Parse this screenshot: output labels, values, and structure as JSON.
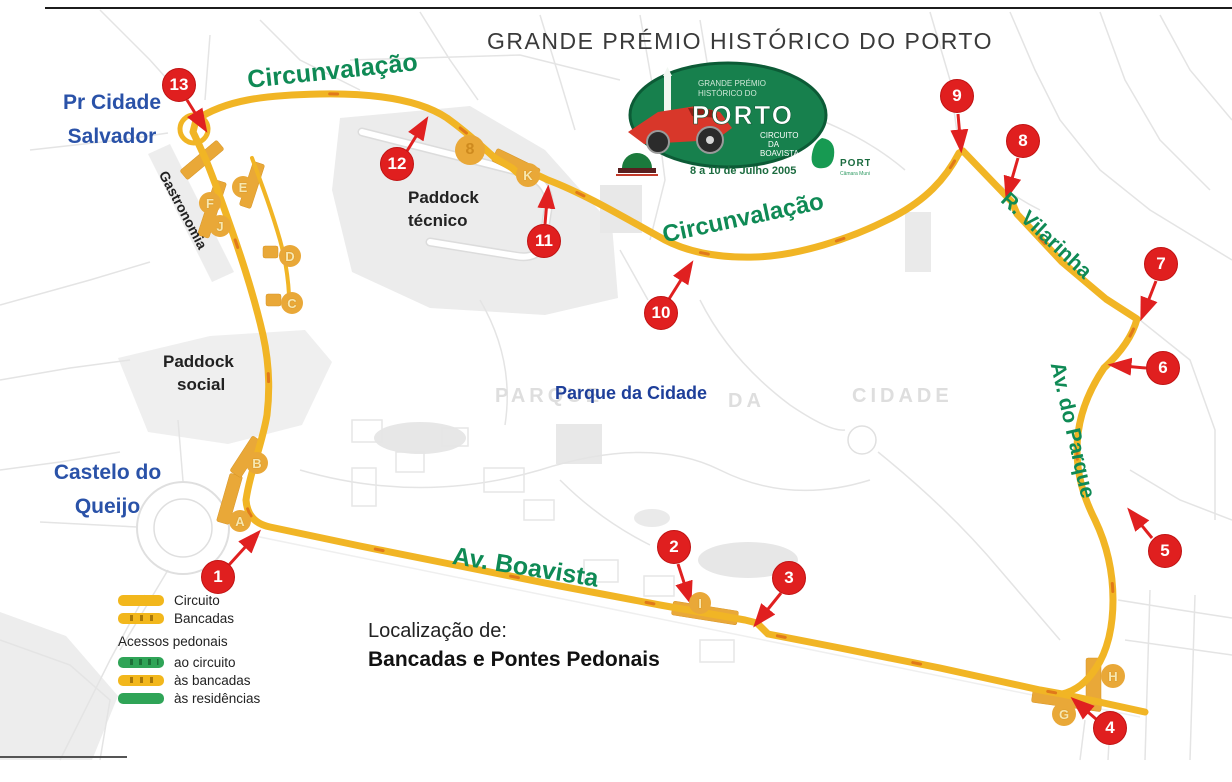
{
  "page": {
    "title": "GRANDE PRÉMIO HISTÓRICO DO PORTO"
  },
  "logo": {
    "line1": "GRANDE PRÉMIO",
    "line2": "HISTÓRICO DO",
    "name": "PORTO",
    "circuit_line1": "CIRCUITO",
    "circuit_line2": "DA",
    "circuit_line3": "BOAVISTA",
    "date": "8 a 10 de Julho 2005",
    "city": "PORTO",
    "city_sub": "Câmara Municipal"
  },
  "labels": {
    "pr_cidade_line1": "Pr Cidade",
    "pr_cidade_line2": "Salvador",
    "castelo_line1": "Castelo do",
    "castelo_line2": "Queijo",
    "paddock_social_line1": "Paddock",
    "paddock_social_line2": "social",
    "paddock_tecnico_line1": "Paddock",
    "paddock_tecnico_line2": "técnico",
    "gastronomia": "Gastronomia",
    "parque_da_cidade": "Parque da Cidade",
    "bg_parque": "PARQUE",
    "bg_da": "DA",
    "bg_cidade": "CIDADE",
    "circunvalacao_top": "Circunvalação",
    "circunvalacao_mid": "Circunvalação",
    "r_vilarinha": "R. Vilarinha",
    "av_do_parque": "Av. do Parque",
    "av_boavista": "Av. Boavista",
    "localizacao": "Localização de:",
    "localizacao_bold": "Bancadas e Pontes Pedonais"
  },
  "legend": {
    "circuito": "Circuito",
    "bancadas": "Bancadas",
    "acessos": "Acessos pedonais",
    "ao_circuito": "ao circuito",
    "as_bancadas": "às bancadas",
    "as_residencias": "às residências"
  },
  "bridges": [
    {
      "label": "1"
    },
    {
      "label": "2"
    },
    {
      "label": "3"
    },
    {
      "label": "4"
    },
    {
      "label": "5"
    },
    {
      "label": "6"
    },
    {
      "label": "7"
    },
    {
      "label": "8"
    },
    {
      "label": "9"
    },
    {
      "label": "10"
    },
    {
      "label": "11"
    },
    {
      "label": "12"
    },
    {
      "label": "13"
    }
  ],
  "stands": [
    {
      "label": "A"
    },
    {
      "label": "B"
    },
    {
      "label": "C"
    },
    {
      "label": "D"
    },
    {
      "label": "E"
    },
    {
      "label": "F"
    },
    {
      "label": "G"
    },
    {
      "label": "H"
    },
    {
      "label": "I"
    },
    {
      "label": "J"
    },
    {
      "label": "K"
    }
  ],
  "extra_marker": {
    "label": "8"
  },
  "colors": {
    "track": "#F1B525",
    "track_dash": "#E0791B",
    "stand_gold": "#E9A838",
    "bridge_red": "#E01F1F",
    "street_green": "#0F8A55",
    "label_blue": "#2A52A8",
    "legend_green": "#2FA457",
    "logo_green": "#17804D"
  }
}
